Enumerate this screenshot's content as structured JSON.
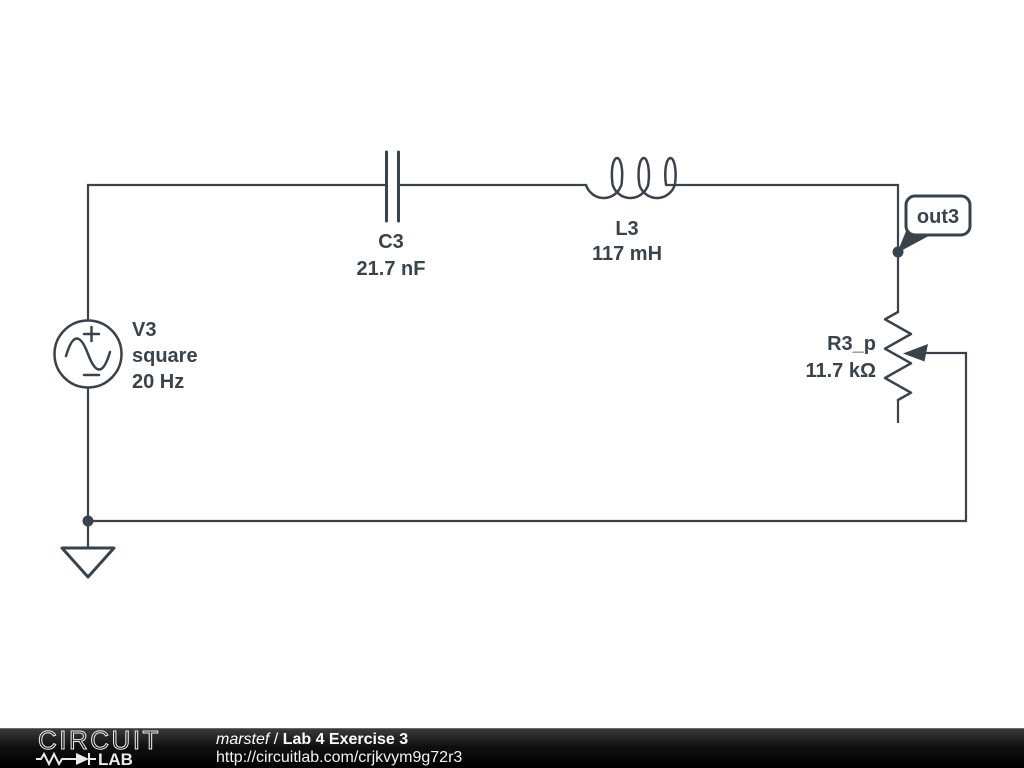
{
  "schematic": {
    "colors": {
      "stroke": "#3a434b",
      "background": "#ffffff"
    },
    "source": {
      "name": "V3",
      "waveform": "square",
      "frequency": "20 Hz"
    },
    "capacitor": {
      "name": "C3",
      "value": "21.7 nF"
    },
    "inductor": {
      "name": "L3",
      "value": "117 mH"
    },
    "potentiometer": {
      "name": "R3_p",
      "value": "11.7 kΩ"
    },
    "net_flag": {
      "label": "out3"
    }
  },
  "footer": {
    "brand_top": "CIRCUIT",
    "brand_bottom": "LAB",
    "author": "marstef",
    "separator": " / ",
    "title": "Lab 4 Exercise 3",
    "url": "http://circuitlab.com/crjkvym9g72r3",
    "colors": {
      "bar": "#000000",
      "text": "#ffffff"
    }
  }
}
